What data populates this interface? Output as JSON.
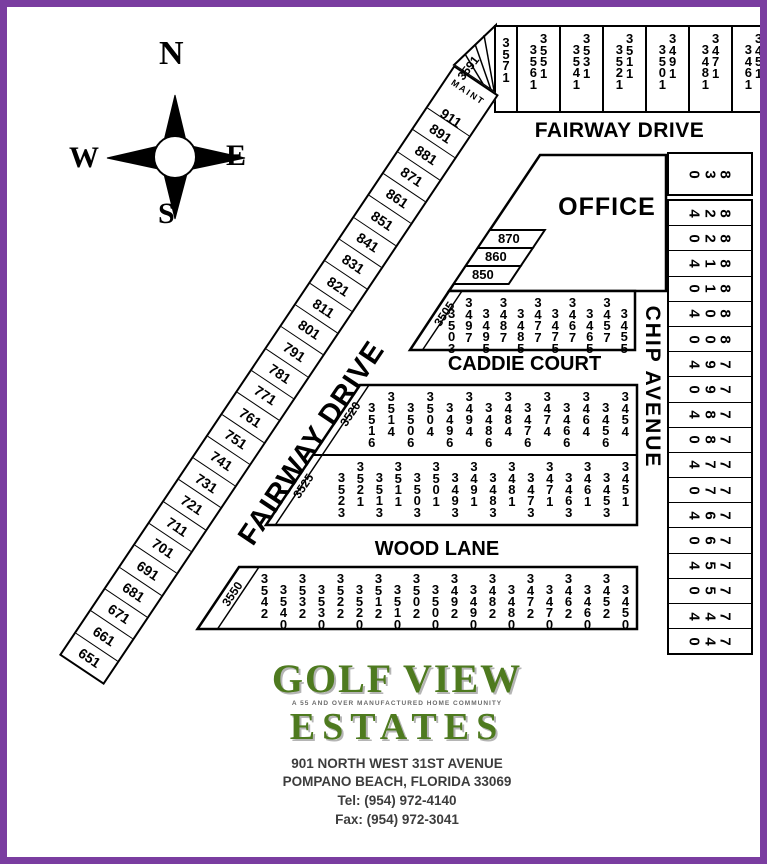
{
  "colors": {
    "border": "#7a3da0",
    "map_line": "#000000",
    "logo_green": "#4e7a1f",
    "address_text": "#3d3d3d"
  },
  "compass": {
    "n": "N",
    "e": "E",
    "s": "S",
    "w": "W"
  },
  "streets": {
    "fairway_top": "FAIRWAY DRIVE",
    "fairway_diagonal": "FAIRWAY DRIVE",
    "caddie": "CADDIE COURT",
    "wood": "WOOD LANE",
    "chip": "CHIP AVENUE"
  },
  "office": {
    "label": "OFFICE",
    "lots": [
      "870",
      "860",
      "850"
    ]
  },
  "top_row": {
    "wedge_lot": "3591",
    "single_lot": "3571",
    "pairs": [
      [
        "3561",
        "3551"
      ],
      [
        "3541",
        "3531"
      ],
      [
        "3521",
        "3511"
      ],
      [
        "3501",
        "3491"
      ],
      [
        "3481",
        "3471"
      ],
      [
        "3461",
        "3451"
      ]
    ]
  },
  "fairway_strip": {
    "maint_label": "MAINT",
    "maint_lot": "911",
    "lots_sw_to_ne": [
      "651",
      "661",
      "671",
      "681",
      "691",
      "701",
      "711",
      "721",
      "731",
      "741",
      "751",
      "761",
      "771",
      "781",
      "791",
      "801",
      "811",
      "821",
      "831",
      "841",
      "851",
      "861",
      "871",
      "881",
      "891"
    ]
  },
  "blocks": {
    "caddie_north": {
      "diagonal_lot": "3505",
      "lots": [
        "3503",
        "3497",
        "3495",
        "3487",
        "3485",
        "3477",
        "3475",
        "3467",
        "3465",
        "3457",
        "3455"
      ]
    },
    "caddie_south": {
      "diagonal_lot": "3520",
      "lots": [
        "3516",
        "3514",
        "3506",
        "3504",
        "3496",
        "3494",
        "3486",
        "3484",
        "3476",
        "3474",
        "3466",
        "3464",
        "3456",
        "3454"
      ]
    },
    "wood_north": {
      "diagonal_lot": "3525",
      "lots": [
        "3523",
        "3521",
        "3513",
        "3511",
        "3503",
        "3501",
        "3493",
        "3491",
        "3483",
        "3481",
        "3473",
        "3471",
        "3463",
        "3461",
        "3453",
        "3451"
      ]
    },
    "wood_south": {
      "diagonal_lot": "3550",
      "lots": [
        "3542",
        "3540",
        "3532",
        "3530",
        "3522",
        "3520",
        "3512",
        "3510",
        "3502",
        "3500",
        "3492",
        "3490",
        "3482",
        "3480",
        "3472",
        "3470",
        "3462",
        "3460",
        "3452",
        "3450"
      ]
    }
  },
  "chip_column": {
    "top_lot": "830",
    "lots": [
      "824",
      "820",
      "814",
      "810",
      "804",
      "800",
      "794",
      "790",
      "784",
      "780",
      "774",
      "770",
      "764",
      "760",
      "754",
      "750",
      "744",
      "740"
    ]
  },
  "logo": {
    "title_line1": "GOLF VIEW",
    "tagline": "A 55 AND OVER MANUFACTURED HOME COMMUNITY",
    "title_line2": "ESTATES",
    "address_line1": "901 NORTH WEST 31ST AVENUE",
    "address_line2": "POMPANO BEACH, FLORIDA 33069",
    "tel": "Tel: (954) 972-4140",
    "fax": "Fax: (954) 972-3041"
  }
}
